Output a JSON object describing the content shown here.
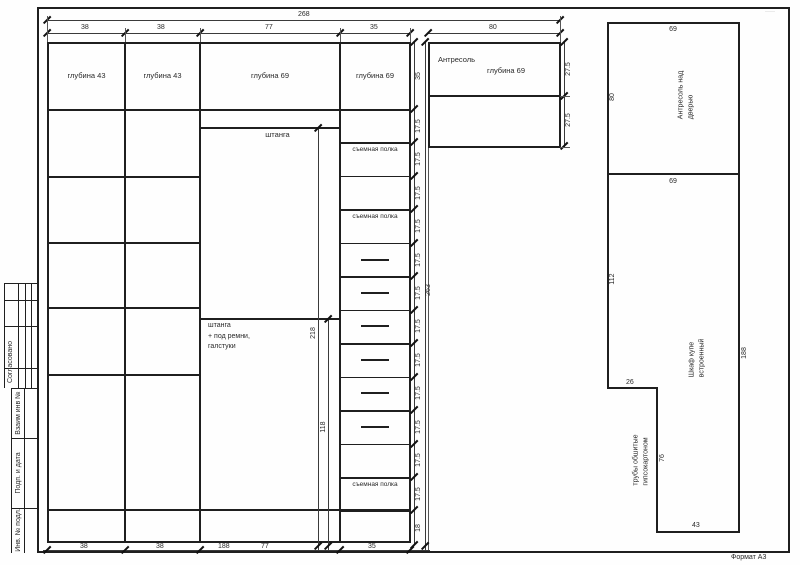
{
  "frame": {
    "format_label": "Формат А3",
    "corner_mark": "·····"
  },
  "title_block": {
    "approved": "Согласовано",
    "cells": [
      "Взаим инв №",
      "Подп. и дата",
      "Инв. № подл."
    ]
  },
  "front_view": {
    "top_total_dim": "268",
    "column_dims": [
      "38",
      "38",
      "77",
      "35"
    ],
    "antresol_width_dim": "80",
    "column_labels": [
      "глубина 43",
      "глубина 43",
      "глубина 69",
      "глубина 69"
    ],
    "antresol_label": "Антресоль",
    "antresol_depth": "глубина 69",
    "antresol_row_dims": [
      "27.5",
      "27.5"
    ],
    "rod_label": "штанга",
    "rod2_label_lines": [
      "штанга",
      "+ под ремни,",
      "галстуки"
    ],
    "rod_dim": "218",
    "rod2_dim": "118",
    "shelf_label": "съемная полка",
    "right_chain": [
      "35",
      "17.5",
      "17.5",
      "17.5",
      "17.5",
      "17.5",
      "17.5",
      "17.5",
      "17.5",
      "17.5",
      "17.5",
      "17.5",
      "17.5",
      "18"
    ],
    "col4_rows": [
      "empty",
      "shelf",
      "empty",
      "shelf",
      "drawer",
      "drawer",
      "drawer",
      "drawer",
      "drawer",
      "drawer",
      "empty",
      "shelf",
      "empty"
    ],
    "total_height_dim": "263",
    "bottom_dims": [
      "38",
      "38",
      "188",
      "77",
      "35"
    ]
  },
  "plan_view": {
    "antresol_box_label_lines": [
      "Антресоль над",
      "дверью"
    ],
    "antresol_box_width_dim": "69",
    "antresol_box_height_dim": "80",
    "closet_width_dim": "69",
    "closet_left_dim": "112",
    "closet_right_dim": "188",
    "step_dim": "26",
    "pipe_height_dim": "76",
    "bottom_width_dim": "43",
    "closet_label_lines": [
      "Шкаф купе",
      "встроенный"
    ],
    "pipes_label_lines": [
      "трубы обшитые",
      "гипсокартоном"
    ]
  }
}
